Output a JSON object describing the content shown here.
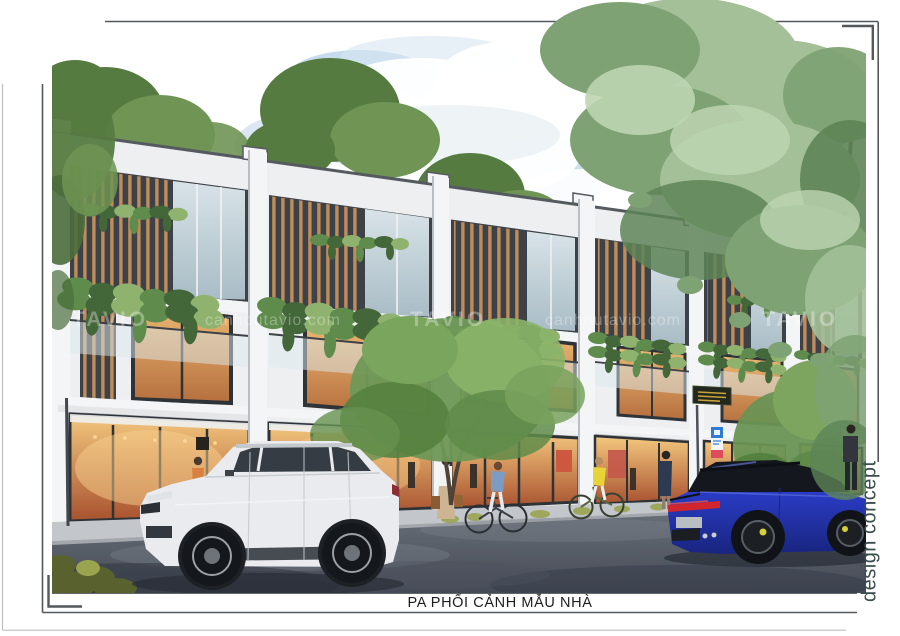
{
  "page": {
    "caption": "PA PHỐI CẢNH MẪU NHÀ",
    "side_label": "design concept"
  },
  "watermarks": {
    "items": [
      {
        "text": "TAVIO"
      },
      {
        "text": "canhoutavio.com"
      },
      {
        "text": "TAVIO"
      },
      {
        "text": "canhoutavio.com"
      },
      {
        "text": "TAVIO"
      }
    ]
  },
  "palette": {
    "frame": "#54585b",
    "pageedge": "#bfbfbf",
    "captext": "#1d1d1f",
    "sidetext": "#3c4d4e",
    "wall": "#edeff1",
    "pilaster": "#f4f5f6",
    "coping": "#555a5e",
    "sidereturn": "#61666b",
    "boxdark": "#3c4247",
    "wood": "#bf8c5a",
    "framedark": "#2e3338",
    "glasscool1": "#d8e3e8",
    "glasscool2": "#a9bcc5",
    "warm1": "#ecb873",
    "warm2": "#b56f3e",
    "shop1": "#f4c97f",
    "shop2": "#a8522f",
    "plant": "#5f8c4c",
    "plantd": "#44673a",
    "plantl": "#8fb36e",
    "bgtree": "#567b41",
    "bgtreeL": "#6f9454",
    "fgtree": "#a3c098",
    "fgtreeM": "#7ea273",
    "fgtreeD": "#5d8457",
    "fgtreeLt": "#bdd5b2",
    "trunk": "#4e4338",
    "sky1": "#bcd6eb",
    "sky2": "#d7e6f2",
    "cloudshade": "#dde7ee",
    "sidewalk": "#c3c7cb",
    "curbface": "#a4a8ac",
    "road1": "#6b7179",
    "road2": "#454a56",
    "suv": "#e9ebee",
    "suvglass": "#363c43",
    "suvroof": "#c3c8cc",
    "carblue1": "#2c3fd0",
    "carblue2": "#19257f",
    "carglass": "#14171d",
    "tailred": "#d2262f",
    "grass": "#9aa44f",
    "grassd": "#59622e",
    "sign1": "#2e7bd6",
    "sign2": "#df4a5c",
    "signboard": "#23281c",
    "signtext": "#c8a23d",
    "watermark": "rgba(255,255,255,0.32)"
  }
}
